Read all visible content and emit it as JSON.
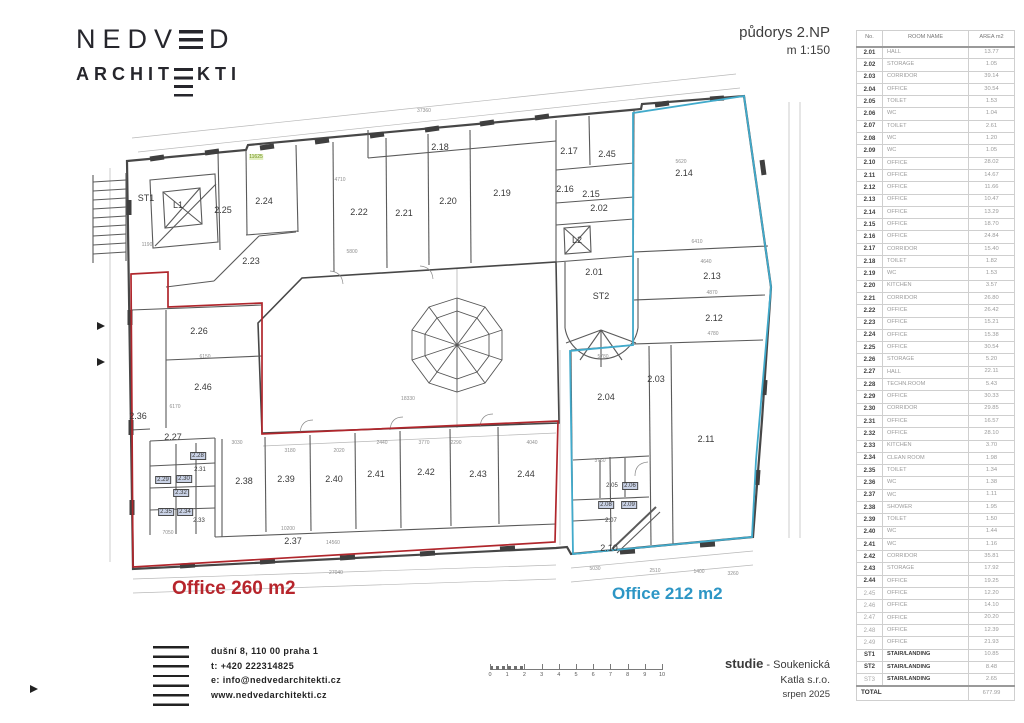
{
  "logo": {
    "line1_pre": "NEDV",
    "line1_post": "D",
    "line2_pre": "ARCHIT",
    "line2_post": "KTI"
  },
  "title": {
    "line1": "půdorys 2.NP",
    "line2": "m 1:150"
  },
  "room_table": {
    "headers": [
      "No.",
      "ROOM NAME",
      "AREA m2"
    ],
    "rows": [
      {
        "no": "2.01",
        "name": "HALL",
        "area": "13.77"
      },
      {
        "no": "2.02",
        "name": "STORAGE",
        "area": "1.05"
      },
      {
        "no": "2.03",
        "name": "CORRIDOR",
        "area": "39.14"
      },
      {
        "no": "2.04",
        "name": "OFFICE",
        "area": "30.54"
      },
      {
        "no": "2.05",
        "name": "TOILET",
        "area": "1.53"
      },
      {
        "no": "2.06",
        "name": "WC",
        "area": "1.04"
      },
      {
        "no": "2.07",
        "name": "TOILET",
        "area": "2.61"
      },
      {
        "no": "2.08",
        "name": "WC",
        "area": "1.20"
      },
      {
        "no": "2.09",
        "name": "WC",
        "area": "1.05"
      },
      {
        "no": "2.10",
        "name": "OFFICE",
        "area": "28.02"
      },
      {
        "no": "2.11",
        "name": "OFFICE",
        "area": "14.67"
      },
      {
        "no": "2.12",
        "name": "OFFICE",
        "area": "11.66"
      },
      {
        "no": "2.13",
        "name": "OFFICE",
        "area": "10.47"
      },
      {
        "no": "2.14",
        "name": "OFFICE",
        "area": "13.29"
      },
      {
        "no": "2.15",
        "name": "OFFICE",
        "area": "18.70"
      },
      {
        "no": "2.16",
        "name": "OFFICE",
        "area": "24.84"
      },
      {
        "no": "2.17",
        "name": "CORRIDOR",
        "area": "15.40"
      },
      {
        "no": "2.18",
        "name": "TOILET",
        "area": "1.82"
      },
      {
        "no": "2.19",
        "name": "WC",
        "area": "1.53"
      },
      {
        "no": "2.20",
        "name": "KITCHEN",
        "area": "3.57"
      },
      {
        "no": "2.21",
        "name": "CORRIDOR",
        "area": "26.80"
      },
      {
        "no": "2.22",
        "name": "OFFICE",
        "area": "26.42"
      },
      {
        "no": "2.23",
        "name": "OFFICE",
        "area": "15.21"
      },
      {
        "no": "2.24",
        "name": "OFFICE",
        "area": "15.38"
      },
      {
        "no": "2.25",
        "name": "OFFICE",
        "area": "30.54"
      },
      {
        "no": "2.26",
        "name": "STORAGE",
        "area": "5.20"
      },
      {
        "no": "2.27",
        "name": "HALL",
        "area": "22.11"
      },
      {
        "no": "2.28",
        "name": "TECHN.ROOM",
        "area": "5.43"
      },
      {
        "no": "2.29",
        "name": "OFFICE",
        "area": "30.33"
      },
      {
        "no": "2.30",
        "name": "CORRIDOR",
        "area": "29.85"
      },
      {
        "no": "2.31",
        "name": "OFFICE",
        "area": "16.57"
      },
      {
        "no": "2.32",
        "name": "OFFICE",
        "area": "28.10"
      },
      {
        "no": "2.33",
        "name": "KITCHEN",
        "area": "3.70"
      },
      {
        "no": "2.34",
        "name": "CLEAN ROOM",
        "area": "1.98"
      },
      {
        "no": "2.35",
        "name": "TOILET",
        "area": "1.34"
      },
      {
        "no": "2.36",
        "name": "WC",
        "area": "1.38"
      },
      {
        "no": "2.37",
        "name": "WC",
        "area": "1.11"
      },
      {
        "no": "2.38",
        "name": "SHOWER",
        "area": "1.95"
      },
      {
        "no": "2.39",
        "name": "TOILET",
        "area": "1.50"
      },
      {
        "no": "2.40",
        "name": "WC",
        "area": "1.44"
      },
      {
        "no": "2.41",
        "name": "WC",
        "area": "1.16"
      },
      {
        "no": "2.42",
        "name": "CORRIDOR",
        "area": "35.81"
      },
      {
        "no": "2.43",
        "name": "STORAGE",
        "area": "17.92"
      },
      {
        "no": "2.44",
        "name": "OFFICE",
        "area": "19.25"
      },
      {
        "no": "2.45",
        "name": "OFFICE",
        "area": "12.20",
        "dim": true
      },
      {
        "no": "2.46",
        "name": "OFFICE",
        "area": "14.10",
        "dim": true
      },
      {
        "no": "2.47",
        "name": "OFFICE",
        "area": "20.20",
        "dim": true
      },
      {
        "no": "2.48",
        "name": "OFFICE",
        "area": "12.39",
        "dim": true
      },
      {
        "no": "2.49",
        "name": "OFFICE",
        "area": "21.93",
        "dim": true
      },
      {
        "no": "ST1",
        "name": "STAIR/LANDING",
        "area": "10.85",
        "stair": true
      },
      {
        "no": "ST2",
        "name": "STAIR/LANDING",
        "area": "8.48",
        "stair": true
      },
      {
        "no": "ST3",
        "name": "STAIR/LANDING",
        "area": "2.65",
        "stair": true,
        "dim": true
      }
    ],
    "total_label": "TOTAL",
    "total_value": "677.99"
  },
  "plan": {
    "office_red_label": "Office 260 m2",
    "office_blue_label": "Office 212 m2",
    "red_color": "#b0262c",
    "blue_color": "#41aacb",
    "room_labels": [
      [
        "ST1",
        146,
        198
      ],
      [
        "L1",
        178,
        205
      ],
      [
        "2.25",
        223,
        210
      ],
      [
        "2.24",
        264,
        201
      ],
      [
        "2.23",
        251,
        261
      ],
      [
        "2.22",
        359,
        212
      ],
      [
        "2.21",
        404,
        213
      ],
      [
        "2.20",
        448,
        201
      ],
      [
        "2.19",
        502,
        193
      ],
      [
        "2.18",
        440,
        147
      ],
      [
        "2.17",
        569,
        151
      ],
      [
        "2.45",
        607,
        154
      ],
      [
        "2.16",
        565,
        189
      ],
      [
        "2.15",
        591,
        194
      ],
      [
        "2.02",
        599,
        208
      ],
      [
        "L2",
        577,
        240
      ],
      [
        "2.01",
        594,
        272
      ],
      [
        "ST2",
        601,
        296
      ],
      [
        "2.14",
        684,
        173
      ],
      [
        "2.13",
        712,
        276
      ],
      [
        "2.12",
        714,
        318
      ],
      [
        "2.03",
        656,
        379
      ],
      [
        "2.04",
        606,
        397
      ],
      [
        "2.11",
        706,
        439
      ],
      [
        "2.26",
        199,
        331
      ],
      [
        "2.46",
        203,
        387
      ],
      [
        "2.36",
        138,
        416
      ],
      [
        "2.27",
        173,
        437
      ],
      [
        "2.38",
        244,
        481
      ],
      [
        "2.39",
        286,
        479
      ],
      [
        "2.40",
        334,
        479
      ],
      [
        "2.41",
        376,
        474
      ],
      [
        "2.42",
        426,
        472
      ],
      [
        "2.43",
        478,
        474
      ],
      [
        "2.44",
        526,
        474
      ],
      [
        "2.37",
        293,
        541
      ],
      [
        "2.10",
        609,
        548
      ]
    ],
    "small_labels": [
      [
        "2.28",
        198,
        456,
        1
      ],
      [
        "2.31",
        200,
        470,
        0
      ],
      [
        "2.29",
        163,
        480,
        1
      ],
      [
        "2.30",
        184,
        479,
        1
      ],
      [
        "2.32",
        181,
        493,
        1
      ],
      [
        "2.35",
        166,
        512,
        1
      ],
      [
        "2.34",
        185,
        512,
        1
      ],
      [
        "2.33",
        199,
        521,
        0
      ],
      [
        "2.05",
        612,
        486,
        0
      ],
      [
        "2.06",
        630,
        486,
        1
      ],
      [
        "2.08",
        606,
        505,
        1
      ],
      [
        "2.09",
        629,
        505,
        1
      ],
      [
        "2.07",
        611,
        521,
        0
      ]
    ],
    "dim_labels": [
      [
        "37360",
        424,
        111
      ],
      [
        "11625",
        256,
        157,
        1
      ],
      [
        "4710",
        340,
        180
      ],
      [
        "5620",
        681,
        162
      ],
      [
        "5800",
        352,
        252
      ],
      [
        "6410",
        697,
        242
      ],
      [
        "4640",
        706,
        262
      ],
      [
        "4870",
        712,
        293
      ],
      [
        "6150",
        205,
        357
      ],
      [
        "18330",
        408,
        399
      ],
      [
        "5780",
        603,
        357
      ],
      [
        "3750",
        600,
        461
      ],
      [
        "4780",
        713,
        334
      ],
      [
        "3030",
        237,
        443
      ],
      [
        "3180",
        290,
        451
      ],
      [
        "2020",
        339,
        451
      ],
      [
        "2440",
        382,
        443
      ],
      [
        "3770",
        424,
        443
      ],
      [
        "2290",
        456,
        443
      ],
      [
        "4040",
        532,
        443
      ],
      [
        "10200",
        288,
        529
      ],
      [
        "7050",
        168,
        533
      ],
      [
        "14560",
        333,
        543
      ],
      [
        "27040",
        336,
        573
      ],
      [
        "5030",
        595,
        569
      ],
      [
        "2510",
        655,
        571
      ],
      [
        "1400",
        699,
        572
      ],
      [
        "3260",
        733,
        574
      ],
      [
        "1190",
        147,
        245
      ],
      [
        "6170",
        175,
        407
      ]
    ]
  },
  "scalebar": {
    "ticks": [
      "0",
      "1",
      "2",
      "3",
      "4",
      "5",
      "6",
      "7",
      "8",
      "9",
      "10"
    ]
  },
  "contact": {
    "lines": [
      "dušní 8, 110 00 praha 1",
      "t: +420 222314825",
      "e: info@nedvedarchitekti.cz",
      "www.nedvedarchitekti.cz"
    ]
  },
  "project": {
    "line1_strong": "studie",
    "line1_rest": " - Soukenická",
    "line2": "Katla s.r.o.",
    "line3": "srpen 2025"
  }
}
